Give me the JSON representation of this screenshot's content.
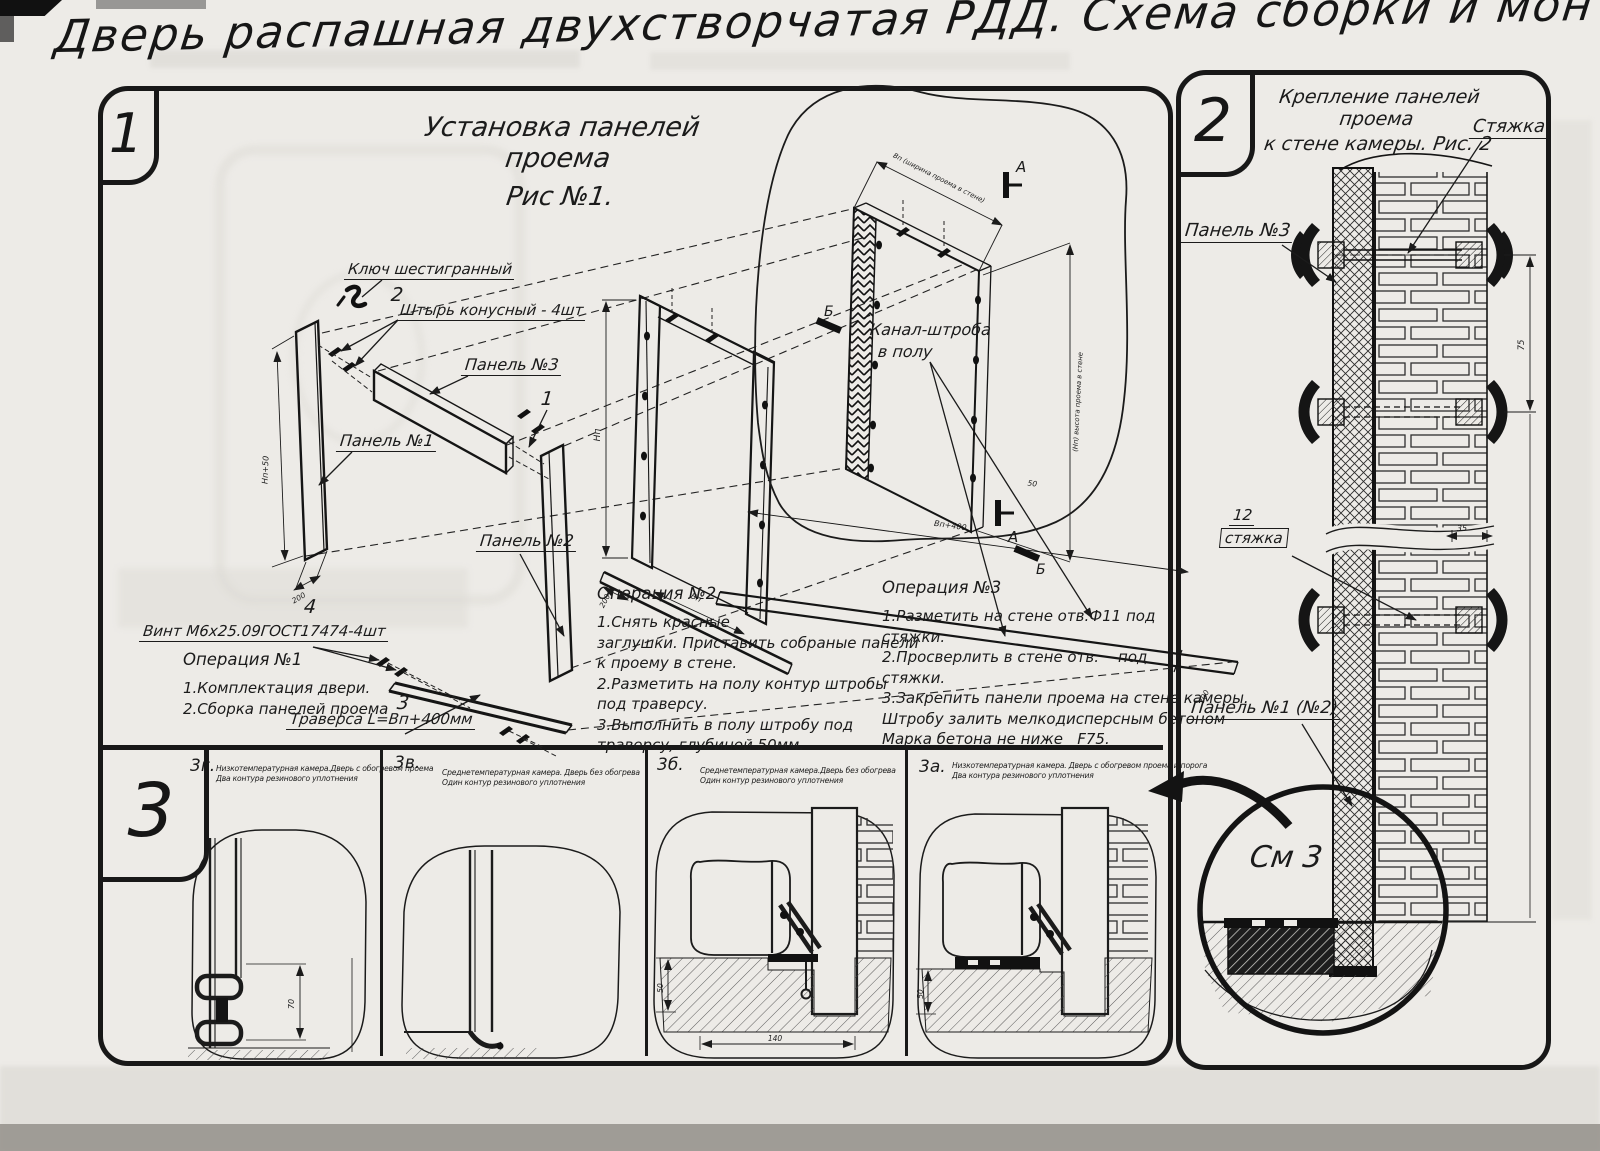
{
  "title": "Дверь распашная двухстворчатая РДД.  Схема сборки и монтажа №2",
  "section1": {
    "marker": "1",
    "fig_title": "Установка панелей проема",
    "fig_subtitle": "Рис №1.",
    "labels": {
      "hex_key": "Ключ шестигранный",
      "pin_num": "2",
      "pin": "Штырь конусный - 4шт",
      "panel3": "Панель №3",
      "panel1": "Панель №1",
      "num1": "1",
      "panel2": "Панель №2",
      "num4": "4",
      "screw": "Винт М6х25.09ГОСТ17474-4шт",
      "num3": "3",
      "traverse": "Траверса  L=Вп+400мм",
      "channel_l1": "Канал-штроба",
      "channel_l2": "в полу",
      "mark_a": "А",
      "mark_b": "Б"
    },
    "dims": {
      "np50": "Нп+50",
      "d200a": "200",
      "np": "Нп",
      "d200b": "200",
      "vp": "Вп",
      "vp400": "Вп+400",
      "d200c": "200",
      "d50": "50",
      "width_top": "Вп (ширина проема в стене)",
      "height_right": "(Нп) высота проема в стене"
    },
    "op1": {
      "title": "Операция №1",
      "lines": [
        "1.Комплектация двери.",
        "2.Сборка панелей проема"
      ]
    },
    "op2": {
      "title": "Операция №2",
      "lines": [
        "1.Снять красные",
        "заглушки. Приставить собраные панели",
        "к проему в стене.",
        "2.Разметить на полу контур штробы",
        "под траверсу.",
        "3.Выполнить в полу штробу под",
        "траверсу, глубиной 50мм."
      ]
    },
    "op3": {
      "title": "Операция №3",
      "lines": [
        "1.Разметить на стене отв.Ф11 под",
        "стяжки.",
        "2.Просверлить в стене отв.    под",
        "стяжки.",
        "3.Закрепить панели проема на стене камеры.",
        "Штробу залить мелкодисперсным бетоном",
        "Марка бетона не ниже   F75."
      ]
    }
  },
  "section2": {
    "marker": "2",
    "title_l1": "Крепление панелей проема",
    "title_l2": "к стене камеры. Рис. 2",
    "labels": {
      "tie": "Стяжка",
      "panel3": "Панель №3",
      "tie_num": "12",
      "tie_small": "стяжка",
      "panel12": "Панель №1 (№2)",
      "see": "См 3"
    },
    "dims": {
      "d75": "75",
      "d35": "35"
    }
  },
  "section3": {
    "marker": "3",
    "details": [
      {
        "id": "3г.",
        "cap1": "Низкотемпературная камера.Дверь с обогревом проема",
        "cap2": "Два контура резинового уплотнения",
        "dim1": "70"
      },
      {
        "id": "3в.",
        "cap1": "Среднетемпературная камера. Дверь без обогрева",
        "cap2": "Один контур резинового уплотнения"
      },
      {
        "id": "3б.",
        "cap1": "Среднетемпературная камера.Дверь без обогрева",
        "cap2": "Один контур резинового уплотнения",
        "dim1": "50",
        "dim2": "140"
      },
      {
        "id": "3а.",
        "cap1": "Низкотемпературная камера. Дверь с обогревом проема и порога",
        "cap2": "Два контура резинового уплотнения",
        "dim1": "50"
      }
    ]
  }
}
